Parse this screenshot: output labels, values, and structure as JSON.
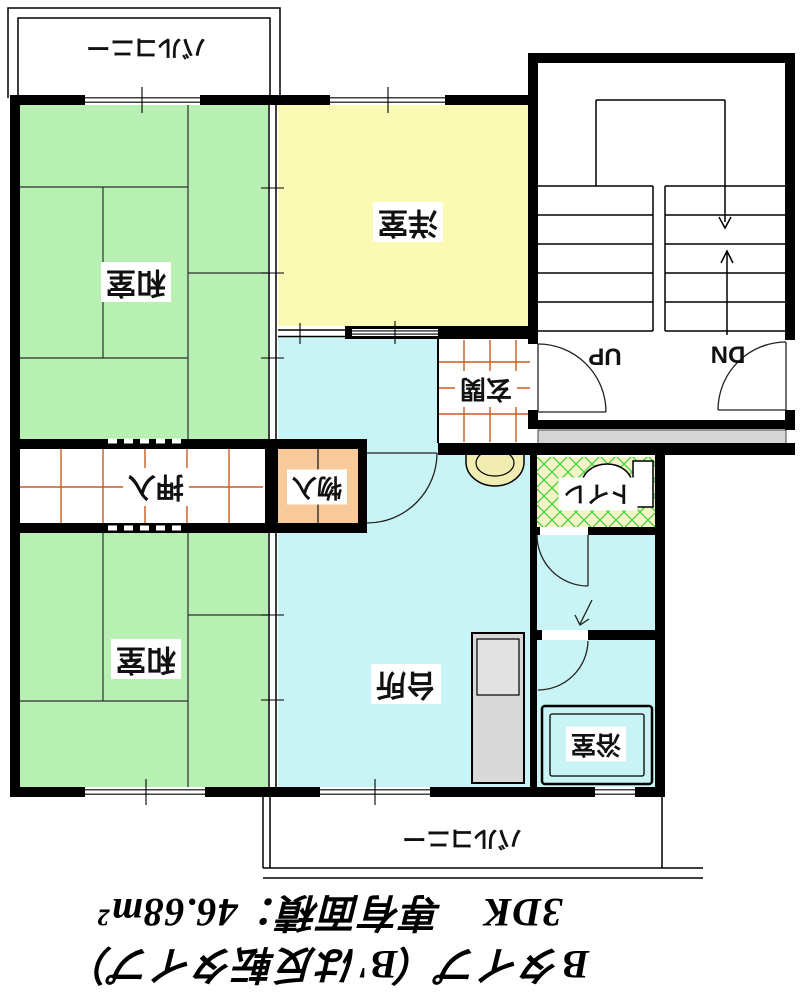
{
  "plan_title": "間取り図",
  "rooms": {
    "washitsu_top": {
      "label": "和室"
    },
    "washitsu_bottom": {
      "label": "和室"
    },
    "yoshitsu": {
      "label": "洋室"
    },
    "daidokoro": {
      "label": "台所"
    },
    "genkan": {
      "label": "玄関"
    },
    "oshiire": {
      "label": "押入"
    },
    "monoire": {
      "label": "物入"
    },
    "toilet": {
      "label": "トイレ"
    },
    "bath": {
      "label": "浴室"
    },
    "balcony_top": {
      "label": "バルコニー"
    },
    "balcony_bottom": {
      "label": "バルコニー"
    }
  },
  "stairs": {
    "up_label": "UP",
    "dn_label": "DN"
  },
  "caption": {
    "type_line": "Bタイプ（B'は反転タイプ）",
    "size_line": "3DK　専有面積：46.68m²"
  },
  "palette": {
    "tatami_green": "#b7f0b2",
    "western_yellow": "#fbfab5",
    "water_cyan": "#c9f4f5",
    "storage_orange": "#f8ca9b",
    "toilet_floor": "#f4f3c6",
    "lattice_green": "#3fd23f",
    "fixture_cream": "#f1edb2",
    "tile_orange": "#c75b22",
    "wall_black": "#000000",
    "gray_strip": "#d6d6d6",
    "unit_gray": "#d9d9d9",
    "unit_gray2": "#e2e2e2"
  }
}
